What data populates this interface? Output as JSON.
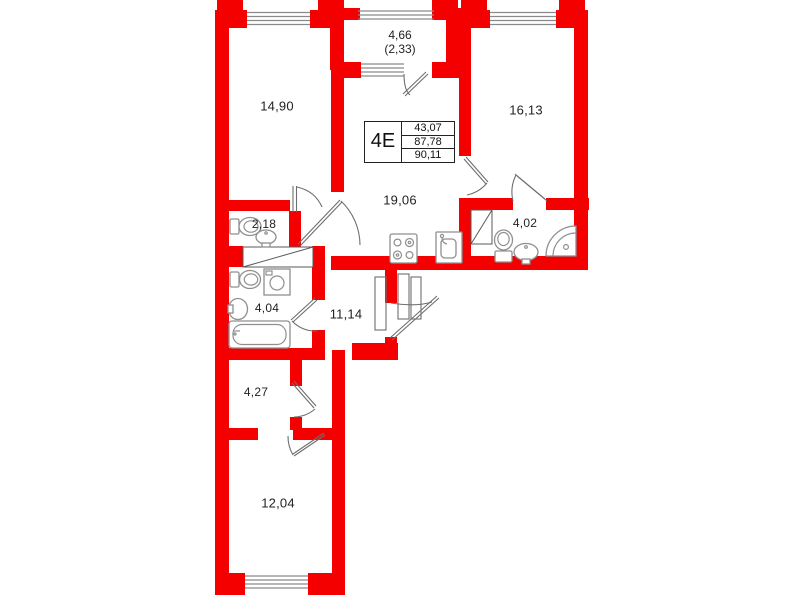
{
  "unit_card": {
    "type": "4E",
    "area_living": "43,07",
    "area_total": "87,78",
    "area_with_balcony": "90,11"
  },
  "rooms": {
    "balcony": {
      "area": "4,66",
      "area_reduced": "(2,33)"
    },
    "bedroom_top_left": {
      "area": "14,90"
    },
    "bedroom_top_right": {
      "area": "16,13"
    },
    "kitchen_living": {
      "area": "19,06"
    },
    "wc": {
      "area": "2,18"
    },
    "bathroom_right": {
      "area": "4,02"
    },
    "bathroom_left": {
      "area": "4,04"
    },
    "hallway": {
      "area": "11,14"
    },
    "storage": {
      "area": "4,27"
    },
    "bedroom_bottom": {
      "area": "12,04"
    }
  },
  "colors": {
    "wall": "#f40000",
    "fixture": "#8f8f8f",
    "door": "#6e6e6e",
    "window": "#8a8a8a",
    "label": "#222222"
  }
}
